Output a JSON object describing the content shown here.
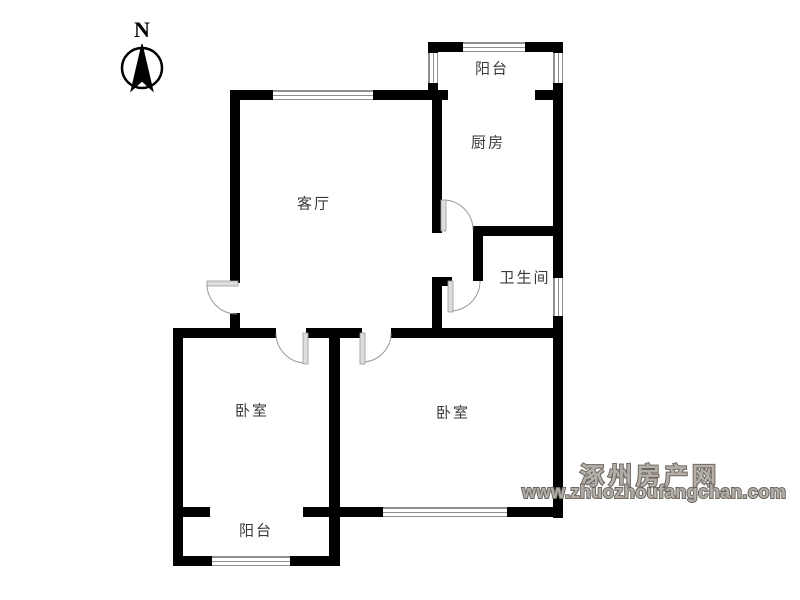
{
  "compass": {
    "label": "N"
  },
  "rooms": {
    "balcony_top": "阳台",
    "kitchen": "厨房",
    "living_room": "客厅",
    "bathroom": "卫生间",
    "bedroom_left": "卧室",
    "bedroom_right": "卧室",
    "balcony_bottom": "阳台"
  },
  "watermark": {
    "site_name": "涿州房产网",
    "site_url": "www.zhuozhoufangchan.com"
  },
  "colors": {
    "wall": "#000000",
    "window_line": "#8f8f8f",
    "door_arc": "#999999",
    "door_leaf": "#dddddd",
    "label_text": "#3a3a3a",
    "watermark_fill": "#b5afa9",
    "watermark_outline": "#6e6761"
  }
}
